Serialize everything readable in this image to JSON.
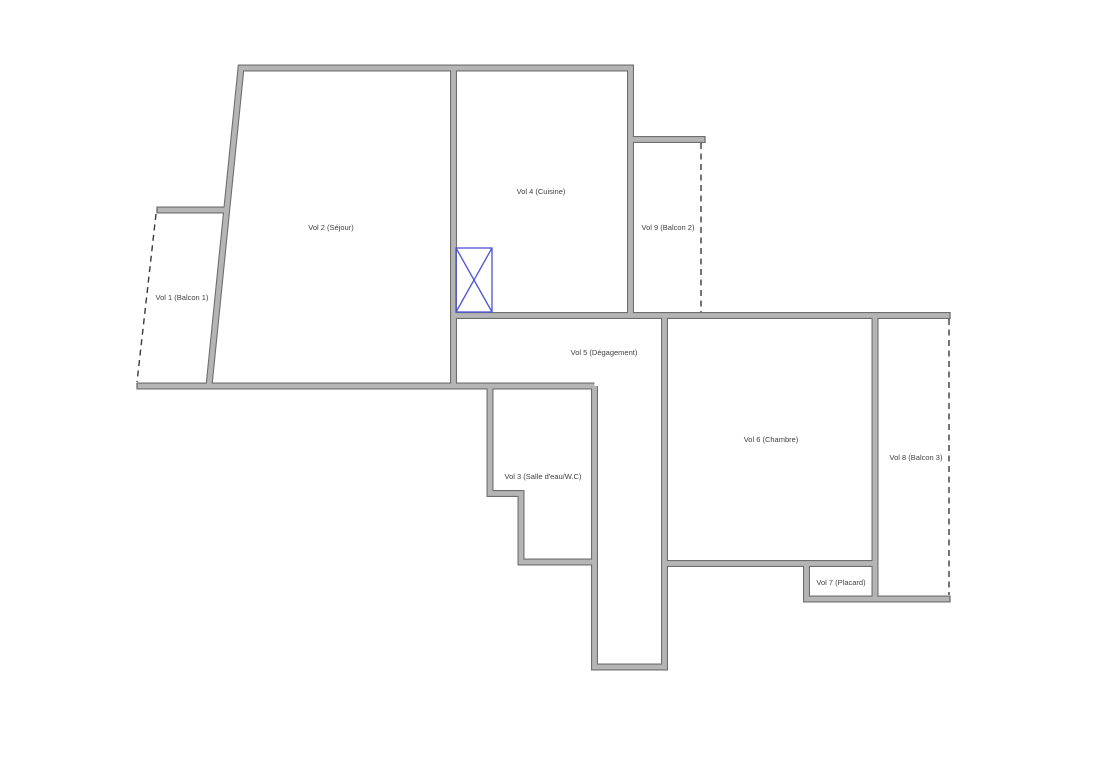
{
  "page": {
    "background": "#ffffff"
  },
  "floor_plan": {
    "rooms": [
      {
        "id": "vol-1",
        "label": "Vol 1 (Balcon 1)",
        "type": "balcony",
        "boundary": "dashed-left-edge"
      },
      {
        "id": "vol-2",
        "label": "Vol 2 (Séjour)",
        "type": "living-room",
        "boundary": "solid"
      },
      {
        "id": "vol-3",
        "label": "Vol 3 (Salle d'eau/W.C)",
        "type": "bathroom-wc",
        "boundary": "solid"
      },
      {
        "id": "vol-4",
        "label": "Vol 4 (Cuisine)",
        "type": "kitchen",
        "boundary": "solid"
      },
      {
        "id": "vol-5",
        "label": "Vol 5 (Dégagement)",
        "type": "hallway",
        "boundary": "solid"
      },
      {
        "id": "vol-6",
        "label": "Vol 6 (Chambre)",
        "type": "bedroom",
        "boundary": "solid"
      },
      {
        "id": "vol-7",
        "label": "Vol 7 (Placard)",
        "type": "closet",
        "boundary": "solid"
      },
      {
        "id": "vol-8",
        "label": "Vol 8 (Balcon 3)",
        "type": "balcony",
        "boundary": "dashed-right-edge"
      },
      {
        "id": "vol-9",
        "label": "Vol 9 (Balcon 2)",
        "type": "balcony",
        "boundary": "dashed-right-edge"
      }
    ],
    "symbols": [
      {
        "id": "shaft",
        "name": "shaft-symbol",
        "shape": "rectangle-with-x",
        "color": "#4a53d6"
      }
    ],
    "colors": {
      "wall_fill": "#b5b5b5",
      "wall_edge": "#6e6e6e",
      "dashed_line": "#3a3a3a",
      "shaft_symbol": "#4a53d6",
      "label_text": "#404040",
      "background": "#ffffff"
    }
  }
}
